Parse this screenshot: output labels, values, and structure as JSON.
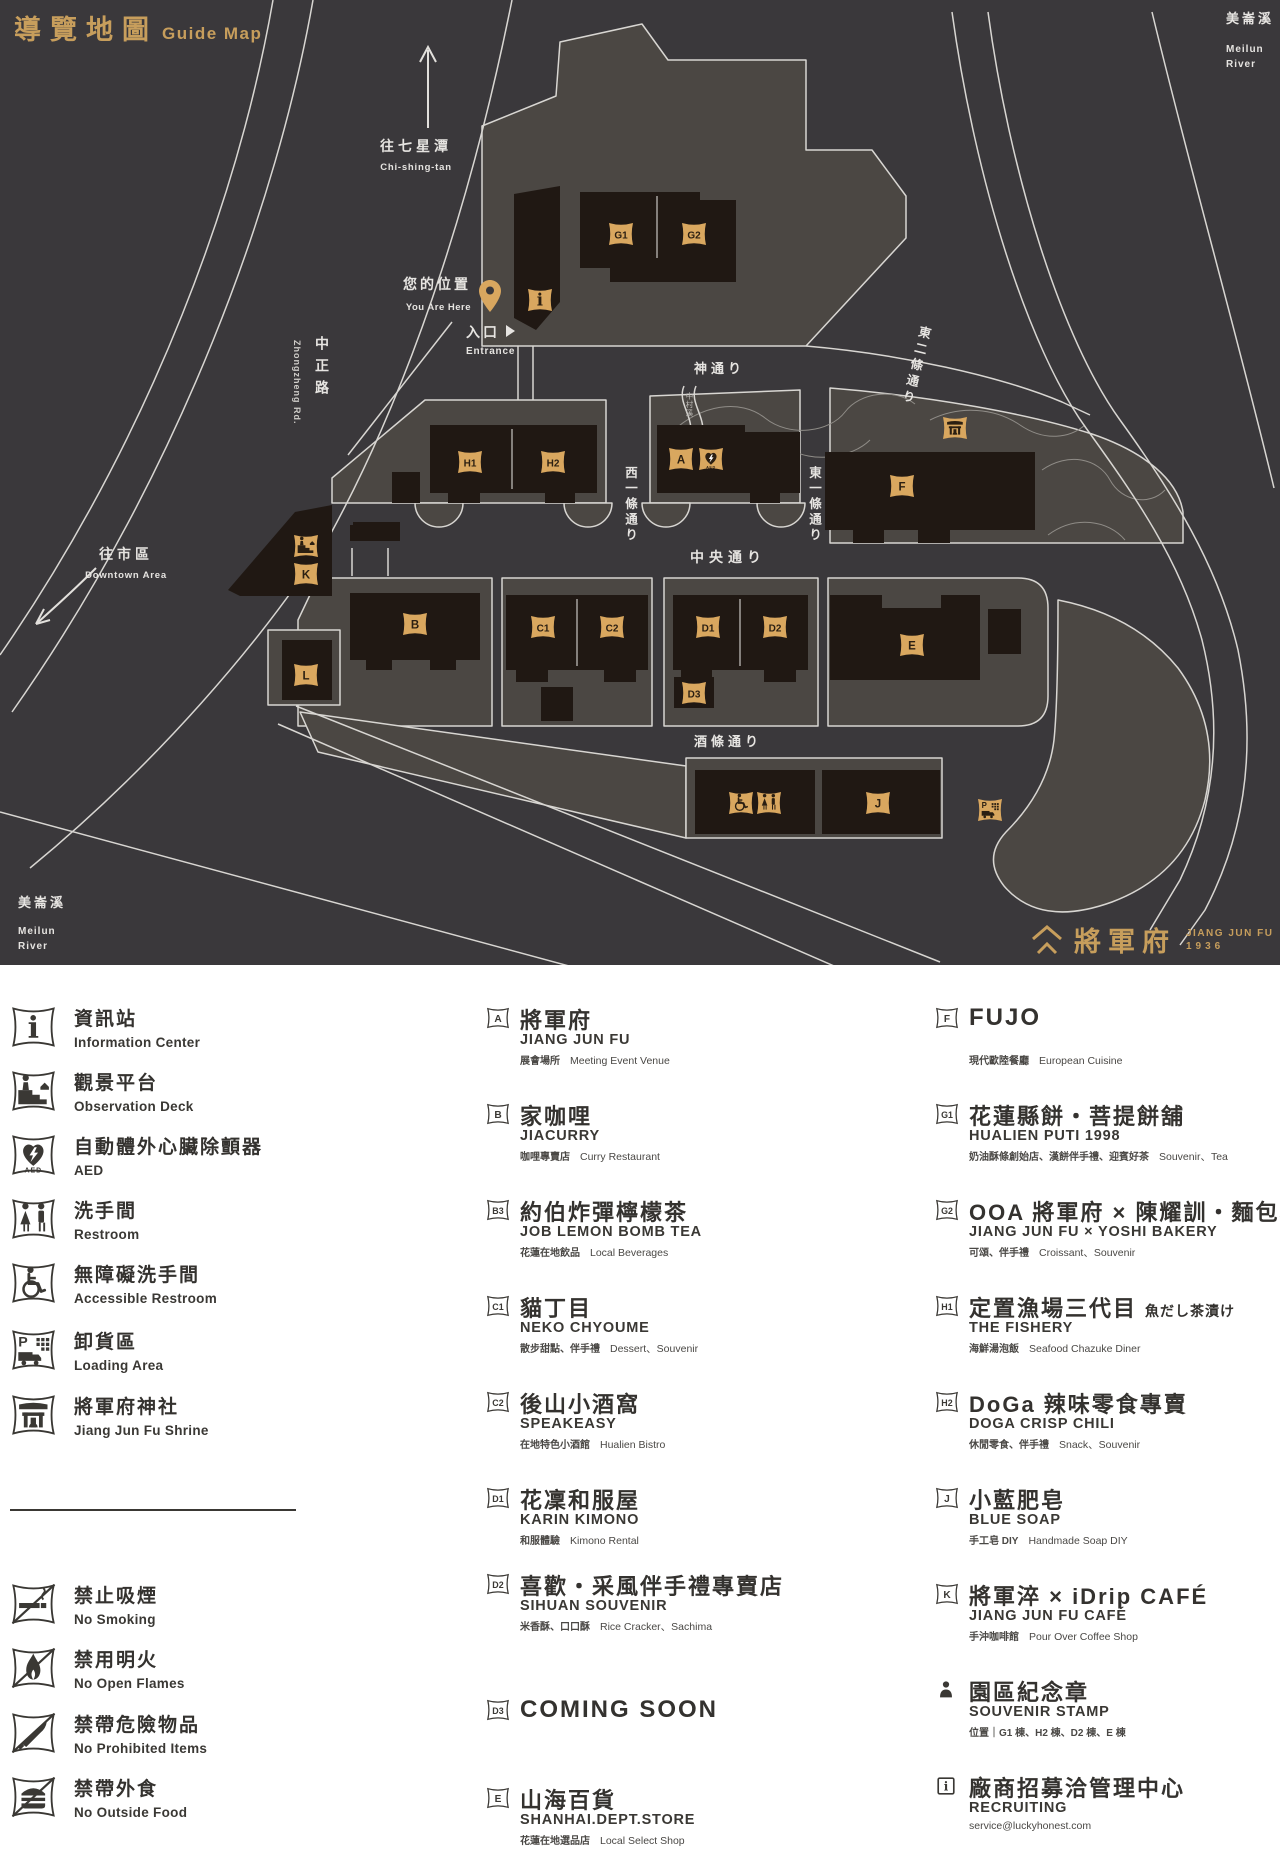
{
  "header": {
    "title": "導覽地圖",
    "subtitle": "Guide Map"
  },
  "map": {
    "labels": {
      "river_tr": {
        "cjk": "美崙溪",
        "en1": "Meilun",
        "en2": "River"
      },
      "river_bl": {
        "cjk": "美崙溪",
        "en1": "Meilun",
        "en2": "River"
      },
      "north": {
        "cjk": "往七星潭",
        "en": "Chi-shing-tan"
      },
      "you_are_here": {
        "cjk": "您的位置",
        "en": "You Are Here"
      },
      "entrance": {
        "cjk": "入口",
        "en": "Entrance"
      },
      "downtown": {
        "cjk": "往市區",
        "en": "Downtown Area"
      },
      "zhongzheng": {
        "cjk": "中正路",
        "en": "Zhongzheng Rd."
      },
      "street_kami": "神通り",
      "street_higashi2": "東二條通り",
      "street_nishi1": "西一條通り",
      "street_higashi1": "東一條通り",
      "street_chuo": "中央通り",
      "street_saka": "酒條通り",
      "stream": "中村溪"
    },
    "logo": {
      "cjk": "將軍府",
      "en": "JIANG JUN FU",
      "year": "1936"
    },
    "tags": [
      {
        "id": "info",
        "glyph": "info",
        "x": 540,
        "y": 300
      },
      {
        "id": "G1",
        "label": "G1",
        "x": 621,
        "y": 234
      },
      {
        "id": "G2",
        "label": "G2",
        "x": 694,
        "y": 234
      },
      {
        "id": "H1",
        "label": "H1",
        "x": 470,
        "y": 462
      },
      {
        "id": "H2",
        "label": "H2",
        "x": 553,
        "y": 462
      },
      {
        "id": "A",
        "label": "A",
        "x": 681,
        "y": 459
      },
      {
        "id": "AED",
        "glyph": "aed",
        "x": 711,
        "y": 459
      },
      {
        "id": "shrine",
        "glyph": "shrine",
        "x": 955,
        "y": 428
      },
      {
        "id": "F",
        "label": "F",
        "x": 902,
        "y": 486
      },
      {
        "id": "observation",
        "glyph": "observation",
        "x": 306,
        "y": 546
      },
      {
        "id": "K",
        "label": "K",
        "x": 306,
        "y": 574
      },
      {
        "id": "B",
        "label": "B",
        "x": 415,
        "y": 624
      },
      {
        "id": "C1",
        "label": "C1",
        "x": 543,
        "y": 627
      },
      {
        "id": "C2",
        "label": "C2",
        "x": 612,
        "y": 627
      },
      {
        "id": "D1",
        "label": "D1",
        "x": 708,
        "y": 627
      },
      {
        "id": "D2",
        "label": "D2",
        "x": 775,
        "y": 627
      },
      {
        "id": "D3",
        "label": "D3",
        "x": 694,
        "y": 693
      },
      {
        "id": "E",
        "label": "E",
        "x": 912,
        "y": 645
      },
      {
        "id": "L",
        "label": "L",
        "x": 306,
        "y": 675
      },
      {
        "id": "wc-accessible",
        "glyph": "accessible",
        "x": 741,
        "y": 803
      },
      {
        "id": "wc",
        "glyph": "restroom",
        "x": 769,
        "y": 803
      },
      {
        "id": "J",
        "label": "J",
        "x": 878,
        "y": 803
      },
      {
        "id": "loading",
        "glyph": "loading",
        "x": 990,
        "y": 810
      }
    ]
  },
  "legend": {
    "facilities": [
      {
        "icon": "info",
        "cjk": "資訊站",
        "en": "Information Center"
      },
      {
        "icon": "observation",
        "cjk": "觀景平台",
        "en": "Observation Deck"
      },
      {
        "icon": "aed",
        "cjk": "自動體外心臟除顫器",
        "en": "AED"
      },
      {
        "icon": "restroom",
        "cjk": "洗手間",
        "en": "Restroom"
      },
      {
        "icon": "accessible",
        "cjk": "無障礙洗手間",
        "en": "Accessible Restroom"
      },
      {
        "icon": "loading",
        "cjk": "卸貨區",
        "en": "Loading Area"
      },
      {
        "icon": "shrine",
        "cjk": "將軍府神社",
        "en": "Jiang Jun Fu Shrine"
      }
    ],
    "prohibitions": [
      {
        "icon": "no-smoking",
        "cjk": "禁止吸煙",
        "en": "No Smoking"
      },
      {
        "icon": "no-flame",
        "cjk": "禁用明火",
        "en": "No Open Flames"
      },
      {
        "icon": "no-dangerous",
        "cjk": "禁帶危險物品",
        "en": "No Prohibited Items"
      },
      {
        "icon": "no-food",
        "cjk": "禁帶外食",
        "en": "No Outside Food"
      }
    ],
    "shops_middle": [
      {
        "tag": "A",
        "title": "將軍府",
        "subtitle": "JIANG JUN FU",
        "desc_cjk": "展會場所",
        "desc_en": "Meeting Event Venue"
      },
      {
        "tag": "B",
        "title": "家咖哩",
        "subtitle": "JIACURRY",
        "desc_cjk": "咖哩專賣店",
        "desc_en": "Curry Restaurant"
      },
      {
        "tag": "B3",
        "title": "約伯炸彈檸檬茶",
        "subtitle": "JOB LEMON BOMB TEA",
        "desc_cjk": "花蓮在地飲品",
        "desc_en": "Local Beverages"
      },
      {
        "tag": "C1",
        "title": "貓丁目",
        "subtitle": "NEKO CHYOUME",
        "desc_cjk": "散步甜點、伴手禮",
        "desc_en": "Dessert、Souvenir"
      },
      {
        "tag": "C2",
        "title": "後山小酒窩",
        "subtitle": "SPEAKEASY",
        "desc_cjk": "在地特色小酒館",
        "desc_en": "Hualien Bistro"
      },
      {
        "tag": "D1",
        "title": "花凜和服屋",
        "subtitle": "KARIN KIMONO",
        "desc_cjk": "和服體驗",
        "desc_en": "Kimono Rental"
      },
      {
        "tag": "D2",
        "title": "喜歡・采風伴手禮專賣店",
        "subtitle": "SIHUAN SOUVENIR",
        "desc_cjk": "米香酥、口口酥",
        "desc_en": "Rice Cracker、Sachima"
      },
      {
        "tag": "D3",
        "title_en": "COMING SOON"
      },
      {
        "tag": "E",
        "title": "山海百貨",
        "subtitle": "SHANHAI.DEPT.STORE",
        "desc_cjk": "花蓮在地選品店",
        "desc_en": "Local Select Shop"
      }
    ],
    "shops_right": [
      {
        "tag": "F",
        "title_en": "FUJO",
        "desc_cjk": "現代歐陸餐廳",
        "desc_en": "European Cuisine"
      },
      {
        "tag": "G1",
        "title": "花蓮縣餅・菩提餅舖",
        "subtitle": "HUALIEN PUTI 1998",
        "desc_cjk": "奶油酥條創始店、漢餅伴手禮、迎賓好茶",
        "desc_en": "Souvenir、Tea"
      },
      {
        "tag": "G2",
        "title": "OOA 將軍府 × 陳耀訓・麵包埠",
        "subtitle": "JIANG JUN FU × YOSHI BAKERY",
        "desc_cjk": "可頌、伴手禮",
        "desc_en": "Croissant、Souvenir"
      },
      {
        "tag": "H1",
        "title": "定置漁場三代目",
        "title_suffix": "魚だし茶漬け",
        "subtitle": "THE FISHERY",
        "desc_cjk": "海鮮湯泡飯",
        "desc_en": "Seafood Chazuke Diner"
      },
      {
        "tag": "H2",
        "title": "DoGa 辣味零食專賣",
        "subtitle": "DOGA CRISP CHILI",
        "desc_cjk": "休閒零食、伴手禮",
        "desc_en": "Snack、Souvenir"
      },
      {
        "tag": "J",
        "title": "小藍肥皂",
        "subtitle": "BLUE SOAP",
        "desc_cjk": "手工皂 DIY",
        "desc_en": "Handmade Soap DIY"
      },
      {
        "tag": "K",
        "title": "將軍淬 × iDrip CAFÉ",
        "subtitle": "JIANG JUN FU CAFÉ",
        "desc_cjk": "手沖咖啡館",
        "desc_en": "Pour Over Coffee Shop"
      },
      {
        "tag": "stamp",
        "icon": "stamp",
        "title": "園區紀念章",
        "subtitle": "SOUVENIR STAMP",
        "desc_cjk": "位置｜G1 棟、H2 棟、D2 棟、E 棟",
        "desc_en": ""
      },
      {
        "tag": "recruit",
        "icon": "boxed-i",
        "title": "廠商招募洽管理中心",
        "subtitle": "RECRUITING",
        "desc_cjk": "",
        "desc_en": "service@luckyhonest.com"
      }
    ]
  }
}
